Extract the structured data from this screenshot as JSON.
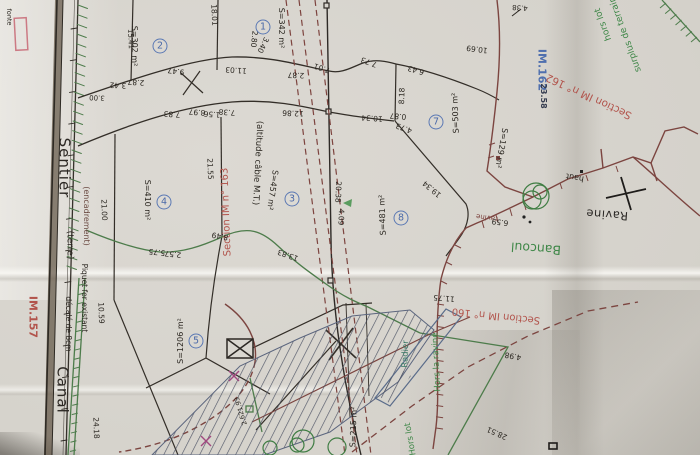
{
  "title": "Plan de bornage cadastral - sections IM, Ravine Bancoul",
  "roads": {
    "sentier": "Sentier",
    "terre": "(terre)",
    "canal": "Canal",
    "encadrement": "(encadrement)",
    "piquet": "Piquet fer existant",
    "piquet_offset": "décalé de 8cm",
    "fonte": "fonte"
  },
  "sections": {
    "im162": "Section IM n° 162",
    "im163": "Section IM n° 163",
    "im160": "Section IM n° 160"
  },
  "refs": {
    "im162": "IM.162",
    "im162_value": "23.58",
    "im157": "IM.157"
  },
  "notes": {
    "surplus1": "surplus de terrain",
    "surplus2": "hors lot",
    "cable": "(altitude câble M.T.)",
    "ravine": "Ravine",
    "bancoul": "Bancoul",
    "haut": "haut",
    "ravine_small": "ravine",
    "radier": "Radier",
    "hors_la_ravine": "Hors la ravine",
    "hors_lot": "Hors lot",
    "s129": "S=129 m²",
    "s215": "S=215 m²"
  },
  "parcels": [
    {
      "num": "1",
      "area": "S=342 m²",
      "cx": 263,
      "cy": 27,
      "ax": 281,
      "ay": 28,
      "ar": 90
    },
    {
      "num": "2",
      "area": "S=302 m²",
      "cx": 160,
      "cy": 46,
      "ax": 134,
      "ay": 46,
      "ar": 90
    },
    {
      "num": "3",
      "area": "S=457 m²",
      "cx": 292,
      "cy": 199,
      "ax": 272,
      "ay": 190,
      "ar": 98
    },
    {
      "num": "4",
      "area": "S=410 m²",
      "cx": 164,
      "cy": 202,
      "ax": 147,
      "ay": 200,
      "ar": 90
    },
    {
      "num": "5",
      "area": "S=1206 m²",
      "cx": 196,
      "cy": 341,
      "ax": 181,
      "ay": 341,
      "ar": 270
    },
    {
      "num": "7",
      "area": "S=503 m²",
      "cx": 436,
      "cy": 122,
      "ax": 456,
      "ay": 113,
      "ar": 268
    },
    {
      "num": "8",
      "area": "S=481 m²",
      "cx": 401,
      "cy": 218,
      "ax": 383,
      "ay": 215,
      "ar": 268
    }
  ],
  "dimensions": [
    {
      "t": "3.42",
      "x": 118,
      "y": 85,
      "r": 183
    },
    {
      "t": "2.87",
      "x": 136,
      "y": 82,
      "r": 183
    },
    {
      "t": "9.47",
      "x": 176,
      "y": 71,
      "r": 188
    },
    {
      "t": "11.03",
      "x": 236,
      "y": 70,
      "r": 184
    },
    {
      "t": "2.87",
      "x": 296,
      "y": 75,
      "r": 182
    },
    {
      "t": "7.01",
      "x": 322,
      "y": 68,
      "r": 198
    },
    {
      "t": "3.00",
      "x": 97,
      "y": 97,
      "r": 183,
      "s": 7
    },
    {
      "t": "7.83",
      "x": 172,
      "y": 114,
      "r": 184
    },
    {
      "t": "8.97",
      "x": 197,
      "y": 112,
      "r": 184
    },
    {
      "t": "1.56",
      "x": 212,
      "y": 114,
      "r": 184
    },
    {
      "t": "7.38",
      "x": 227,
      "y": 112,
      "r": 184
    },
    {
      "t": "12.86",
      "x": 293,
      "y": 113,
      "r": 182
    },
    {
      "t": "18.01",
      "x": 214,
      "y": 15,
      "r": 87
    },
    {
      "t": "15.41",
      "x": 130,
      "y": 39,
      "r": 88,
      "s": 7
    },
    {
      "t": "2.80",
      "x": 254,
      "y": 39,
      "r": 96
    },
    {
      "t": "3.40",
      "x": 263,
      "y": 45,
      "r": 116
    },
    {
      "t": "7.73",
      "x": 369,
      "y": 62,
      "r": 200
    },
    {
      "t": "6.43",
      "x": 416,
      "y": 70,
      "r": 196
    },
    {
      "t": "8.18",
      "x": 402,
      "y": 96,
      "r": 272
    },
    {
      "t": "0.87",
      "x": 398,
      "y": 116,
      "r": 185
    },
    {
      "t": "4.73",
      "x": 404,
      "y": 128,
      "r": 200
    },
    {
      "t": "10.34",
      "x": 372,
      "y": 118,
      "r": 184
    },
    {
      "t": "10.69",
      "x": 477,
      "y": 49,
      "r": 187
    },
    {
      "t": "4.38",
      "x": 520,
      "y": 7,
      "r": 184,
      "s": 7
    },
    {
      "t": "19.34",
      "x": 432,
      "y": 189,
      "r": 220
    },
    {
      "t": "13.83",
      "x": 288,
      "y": 255,
      "r": 200
    },
    {
      "t": "8.49",
      "x": 220,
      "y": 236,
      "r": 190
    },
    {
      "t": "5.75",
      "x": 157,
      "y": 252,
      "r": 186
    },
    {
      "t": "2.57",
      "x": 173,
      "y": 254,
      "r": 186
    },
    {
      "t": "21.00",
      "x": 104,
      "y": 210,
      "r": 88
    },
    {
      "t": "21.55",
      "x": 210,
      "y": 169,
      "r": 88
    },
    {
      "t": "10.59",
      "x": 101,
      "y": 313,
      "r": 88
    },
    {
      "t": "24.18",
      "x": 96,
      "y": 428,
      "r": 88
    },
    {
      "t": "28.51",
      "x": 497,
      "y": 433,
      "r": 204
    },
    {
      "t": "4.98",
      "x": 513,
      "y": 356,
      "r": 190
    },
    {
      "t": "6.59",
      "x": 500,
      "y": 222,
      "r": 187
    },
    {
      "t": "11.75",
      "x": 444,
      "y": 298,
      "r": 185
    },
    {
      "t": "20.38",
      "x": 338,
      "y": 192,
      "r": 92
    },
    {
      "t": "4.09",
      "x": 341,
      "y": 217,
      "r": 92
    },
    {
      "t": "1.93",
      "x": 239,
      "y": 404,
      "r": 252,
      "s": 6.5
    },
    {
      "t": "2.62",
      "x": 243,
      "y": 418,
      "r": 252,
      "s": 6.5
    }
  ],
  "colors": {
    "paper": "#d5d2cb",
    "ink": "#332e28",
    "maroon_line": "#7c4540",
    "green_line": "#4d7c4b",
    "blue_structure": "#5a6c8a",
    "red_label": "#b2544c",
    "blue_label": "#4f6fae",
    "hatch": "#4b5163",
    "magenta_mark": "#a0487f",
    "pink_box": "#cc7a84"
  }
}
